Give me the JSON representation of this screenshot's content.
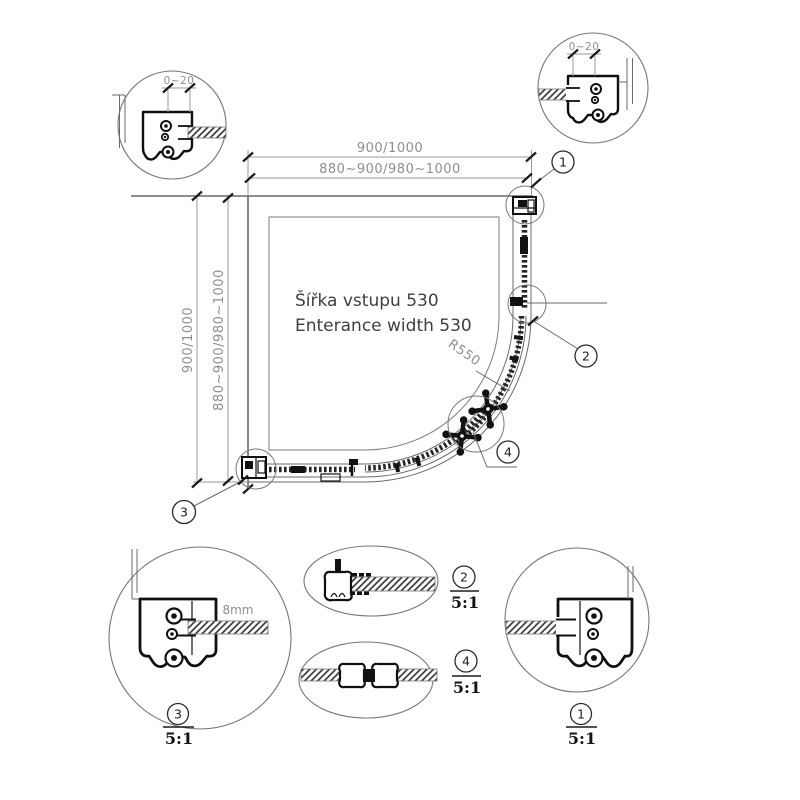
{
  "colors": {
    "background": "#ffffff",
    "line": "#4a4a4a",
    "bold_line": "#101010",
    "dim_text": "#8e8e8e",
    "dark_text": "#3f3f3f"
  },
  "plan": {
    "dim_top_outer": "900/1000",
    "dim_top_inner": "880~900/980~1000",
    "dim_left_outer": "900/1000",
    "dim_left_inner": "880~900/980~1000",
    "radius_label": "R550",
    "entrance_label_cz": "Šířka vstupu 530",
    "entrance_label_en": "Enterance width 530",
    "callout_1": "1",
    "callout_2": "2",
    "callout_3": "3",
    "callout_4": "4"
  },
  "detail_top_left": {
    "adjust_dim": "0~20"
  },
  "detail_top_right": {
    "adjust_dim": "0~20"
  },
  "detail_bottom_left": {
    "number": "3",
    "scale": "5:1",
    "glass_thickness": "8mm"
  },
  "detail_mid_upper": {
    "number": "2",
    "scale": "5:1"
  },
  "detail_mid_lower": {
    "number": "4",
    "scale": "5:1"
  },
  "detail_bottom_right": {
    "number": "1",
    "scale": "5:1"
  }
}
